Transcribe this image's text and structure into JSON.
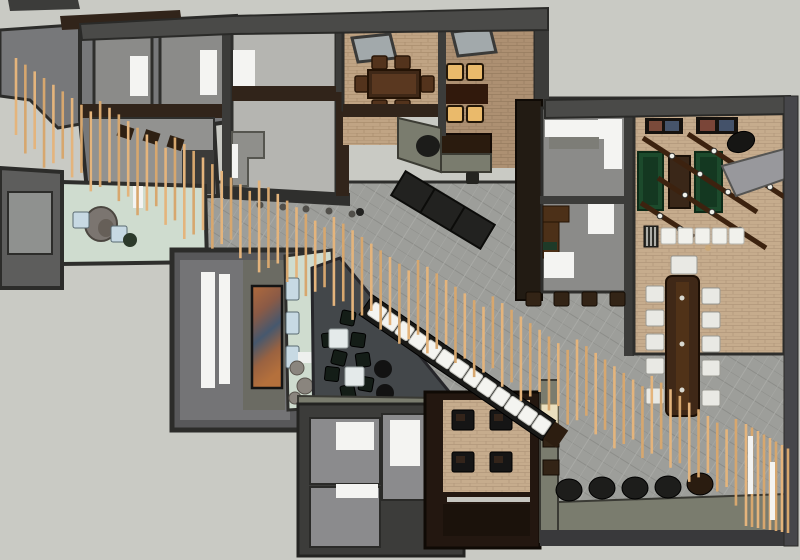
{
  "scene": {
    "type": "3d-overhead-floor-plan",
    "description": "SketchUp-style top-down 3D rendering of an office / restaurant interior with a diagonal timber slat baffle running from upper-left to lower-right",
    "no_visible_text": true
  },
  "palette": {
    "background": "#c9cac4",
    "wall_dark": "#3c3c3a",
    "wall_mid": "#4a4a48",
    "roof": "#77787a",
    "room_floor": "#8b8b89",
    "walkway_tile": "#9d9e9a",
    "mint": "#cfdccf",
    "charcoal": "#43474a",
    "olive": "#7a7c6e",
    "wood_dark": "#31241a",
    "wood_table": "#3f2817",
    "brick": "#c0a484",
    "brick_dark": "#ad9072",
    "slat": "#e4b47c",
    "slat_alt": "#d7a76e",
    "white_panel": "#f4f4f2",
    "amber_seat": "#eaba6b",
    "green_table": "#1c4a2c",
    "blue_seat": "#c7d9e3",
    "black_obj": "#1c1c1a",
    "white_chair": "#e9e9e4"
  },
  "inventory": {
    "slat_count": 78,
    "fence_slat_count": 8,
    "conference_chairs": 11,
    "white_bar_stools": 5,
    "black_floor_cylinders": 5,
    "dining_chairs": 6,
    "lit_booth_seats": 4,
    "dark_booth_seats": 4,
    "green_game_tables": 3,
    "lounge_poufs": 8,
    "lounge_tables": 2,
    "bench_cushions": 13
  }
}
